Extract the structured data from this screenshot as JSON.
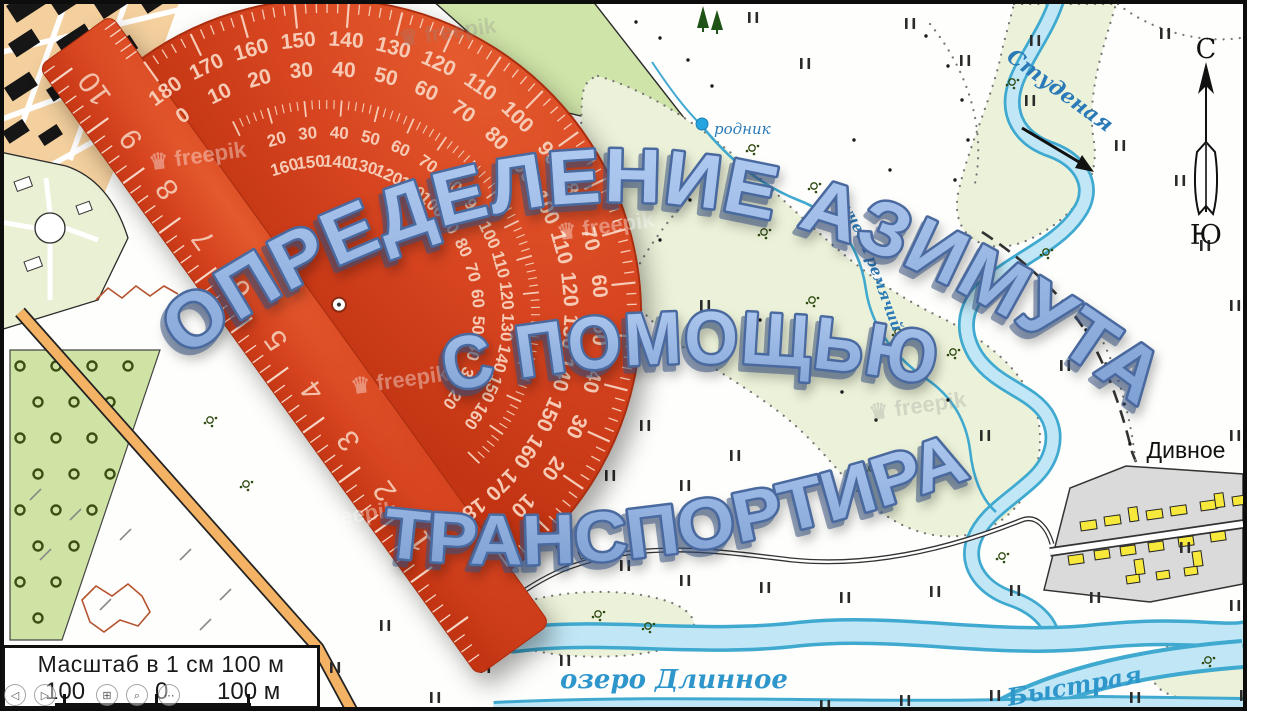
{
  "title": {
    "line1": "ОПРЕДЕЛЕНИЕ АЗИМУТА",
    "line2": "С ПОМОЩЬЮ",
    "line3": "ТРАНСПОРТИРА"
  },
  "map_labels": {
    "river_top": "Студеная",
    "stream": "ручей Гремячий",
    "spring": "родник",
    "village_right": "Дивное",
    "village_center": "По",
    "lake": "озеро Длинное",
    "river_bottom": "Быстрая"
  },
  "compass": {
    "north": "С",
    "south": "Ю"
  },
  "scale_box": {
    "title": "Масштаб в 1 см 100 м",
    "left_value": "100",
    "zero_value": "0",
    "right_value": "100 м"
  },
  "protractor": {
    "degrees": [
      "0",
      "10",
      "20",
      "30",
      "40",
      "50",
      "60",
      "70",
      "80",
      "90",
      "100",
      "110",
      "120",
      "130",
      "140",
      "150",
      "160",
      "170",
      "180"
    ],
    "ruler_numbers": [
      "10",
      "9",
      "8",
      "7",
      "6",
      "5",
      "4",
      "3",
      "2",
      "1"
    ],
    "body_color": "#d5431f",
    "marking_color": "#f6cab4"
  },
  "watermark": {
    "symbol": "♛",
    "text": "freepik"
  },
  "player_controls": [
    {
      "name": "back-icon",
      "glyph": "◁"
    },
    {
      "name": "play-icon",
      "glyph": "▷"
    },
    {
      "name": "grid-icon",
      "glyph": "⊞"
    },
    {
      "name": "zoom-icon",
      "glyph": "⌕"
    },
    {
      "name": "more-icon",
      "glyph": "⋯"
    }
  ],
  "colors": {
    "title_fill": "#8fb0e2",
    "title_outline": "#49699f",
    "water_fill": "#c1e7f6",
    "water_edge": "#3fa9d0",
    "vegetation": "#ecf2d9",
    "orchard": "#cfe4a4",
    "road_orange": "#f3b264",
    "building_yellow": "#f6e93c",
    "village_gray": "#dadada",
    "label_blue": "#2b7ab8"
  }
}
